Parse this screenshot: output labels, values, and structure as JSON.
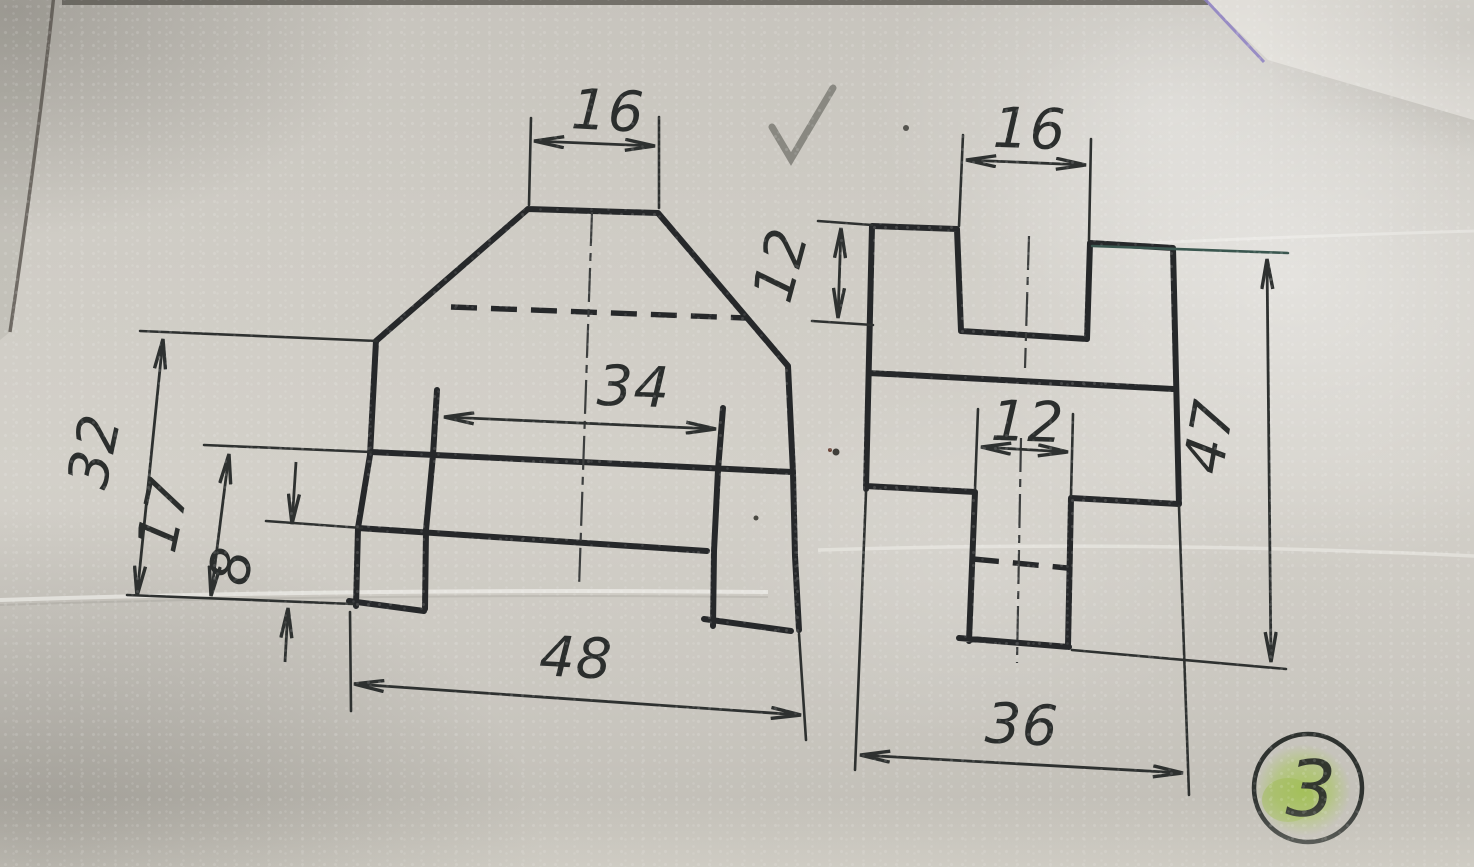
{
  "scene": {
    "description": "Photograph of a technical drawing exercise: two orthographic views of a machined support block on textured paper",
    "checkmark": "✓",
    "sheet_number": "3"
  },
  "front_view": {
    "label": "front view",
    "dims": {
      "top_width": "16",
      "inner_width": "34",
      "overall_width": "48",
      "body_height": "32",
      "rail_height": "17",
      "base_notch_height": "8"
    }
  },
  "side_view": {
    "label": "side view",
    "dims": {
      "top_width": "16",
      "groove_depth": "12",
      "stem_width": "12",
      "overall_height": "47",
      "overall_width": "36"
    }
  },
  "colors": {
    "ink": "#26282a",
    "dimension_ink": "#2e3130",
    "teal_ink": "#3a564f",
    "pencil": "#83827c",
    "highlight_green": "#a8c45a",
    "paper": "#cdcac3"
  }
}
